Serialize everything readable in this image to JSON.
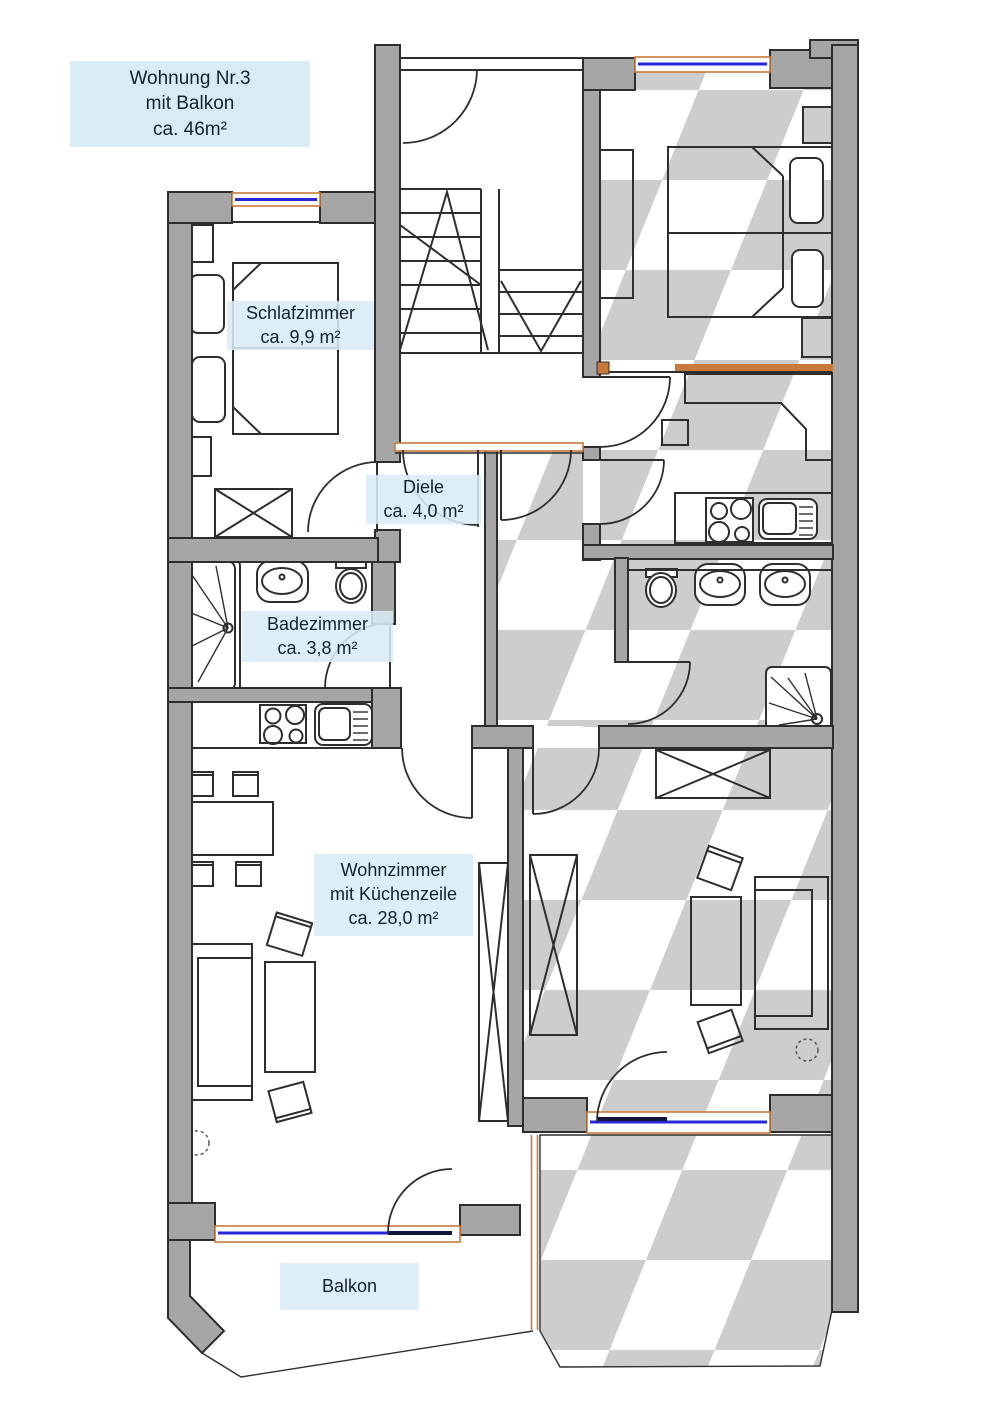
{
  "plan": {
    "title_box": {
      "line1": "Wohnung Nr.3",
      "line2": "mit Balkon",
      "line3": "ca. 46m²"
    },
    "room_labels": {
      "schlafzimmer": {
        "name": "Schlafzimmer",
        "area": "ca. 9,9 m²"
      },
      "diele": {
        "name": "Diele",
        "area": "ca. 4,0 m²"
      },
      "badezimmer": {
        "name": "Badezimmer",
        "area": "ca. 3,8 m²"
      },
      "wohnzimmer": {
        "name": "Wohnzimmer",
        "line2": "mit Küchenzeile",
        "area": "ca. 28,0 m²"
      },
      "balkon": {
        "name": "Balkon"
      }
    },
    "colors": {
      "wall": "#a6a6a6",
      "outline": "#2e2e2e",
      "hatch": "#cdcdcd",
      "window_frame": "#c97a3b",
      "window_glass": "#2727d8",
      "door_leaf": "#15153a",
      "label_bg": "#d8ecf6",
      "text": "#16212b"
    }
  }
}
